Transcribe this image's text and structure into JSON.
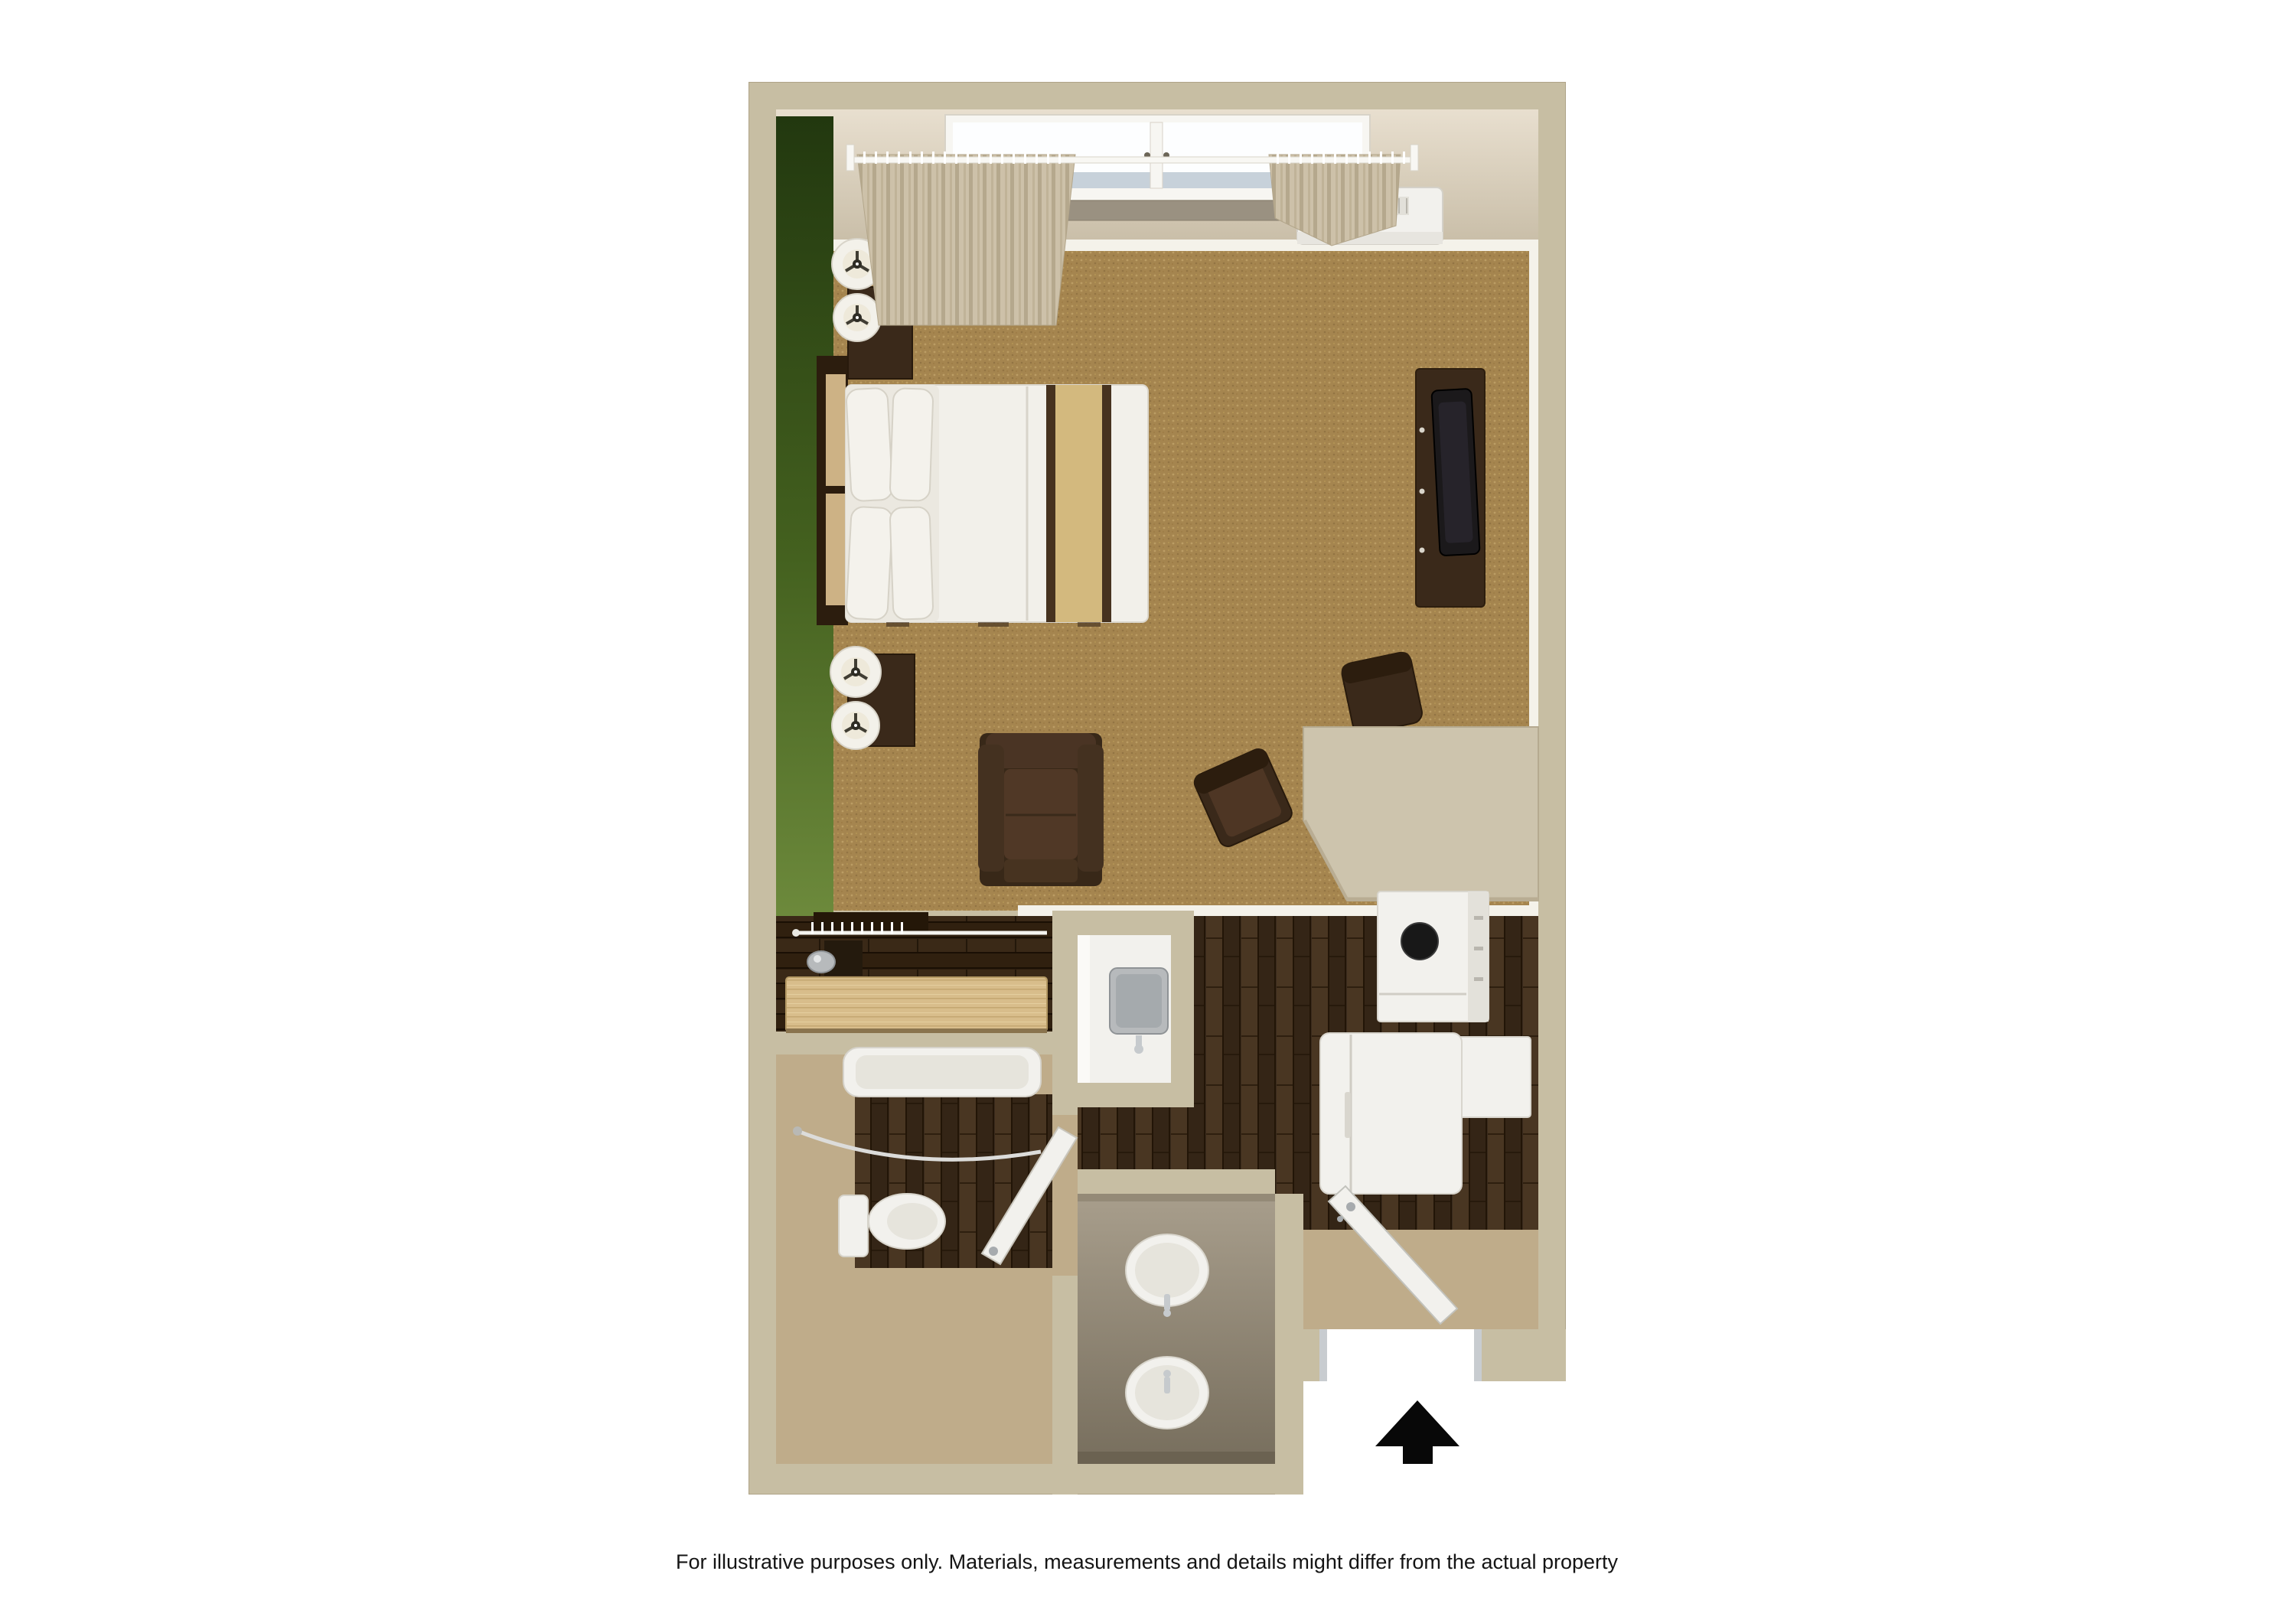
{
  "page": {
    "caption": "For illustrative purposes only.  Materials, measurements and details might differ from the actual property",
    "background": "#ffffff"
  },
  "floor_plan": {
    "view": "3d-top-down-studio-suite",
    "rooms": [
      {
        "name": "living-sleeping-area",
        "floor": "carpet"
      },
      {
        "name": "kitchen",
        "floor": "dark-wood"
      },
      {
        "name": "closet",
        "floor": "dark-wood"
      },
      {
        "name": "bathroom",
        "floor": "dark-wood-and-vinyl"
      },
      {
        "name": "vanity-area",
        "floor": "vinyl"
      },
      {
        "name": "entry",
        "floor": "dark-wood"
      }
    ],
    "fixtures": [
      "window",
      "curtain-left",
      "curtain-right",
      "curtain-rod",
      "hvac-unit",
      "headboard",
      "bed",
      "pillows",
      "nightstand-top",
      "nightstand-bottom",
      "table-lamps",
      "tv-console",
      "tv",
      "armchair",
      "desk-chair",
      "side-chair",
      "counter-desk",
      "kitchen-sink-counter",
      "kitchen-sink",
      "stove",
      "wall-cabinet",
      "refrigerator",
      "closet-rod",
      "hangers",
      "iron",
      "luggage-bench",
      "bathtub",
      "shower-rod",
      "toilet",
      "bathroom-door",
      "vanity-counter",
      "vanity-sink-1",
      "vanity-sink-2",
      "entry-door",
      "entry-threshold",
      "entrance-arrow"
    ],
    "colors": {
      "wall": "#c7bea3",
      "wall_face": "#d9cfbf",
      "baseboard": "#f4f2ea",
      "green_wall": "#3d5b1f",
      "carpet": "#a5854f",
      "wood_dark": "#3a2b1d",
      "closet_wood": "#2c1e10",
      "bench_wood": "#d8bd8b",
      "tan_floor": "#bfac8a",
      "fixture_white": "#f2f1ed",
      "fixture_shadow": "#d8d5cc",
      "appliance_inner": "#e6e4dc",
      "counter_greige": "#cdc4ad",
      "vanity_counter": "#968c79",
      "furniture_dark": "#3a291a",
      "furniture_darker": "#2c1d0e",
      "cushion": "#503826",
      "headboard_inset": "#cdb285",
      "runner_tan": "#d3b97e",
      "band_dark": "#46321f",
      "tv_black": "#1b191b",
      "glass": "#fdfeff",
      "glass_shade": "#bdc9d4",
      "sill": "#9a9181",
      "curtain": "#cdc1a9",
      "curtain_fold": "#b5a88d",
      "stainless": "#b7babc",
      "stainless_dark": "#8f9396",
      "chrome": "#c6cacd",
      "jamb": "#c8ccd0",
      "arrow": "#080808",
      "caption_text": "#141414"
    }
  }
}
